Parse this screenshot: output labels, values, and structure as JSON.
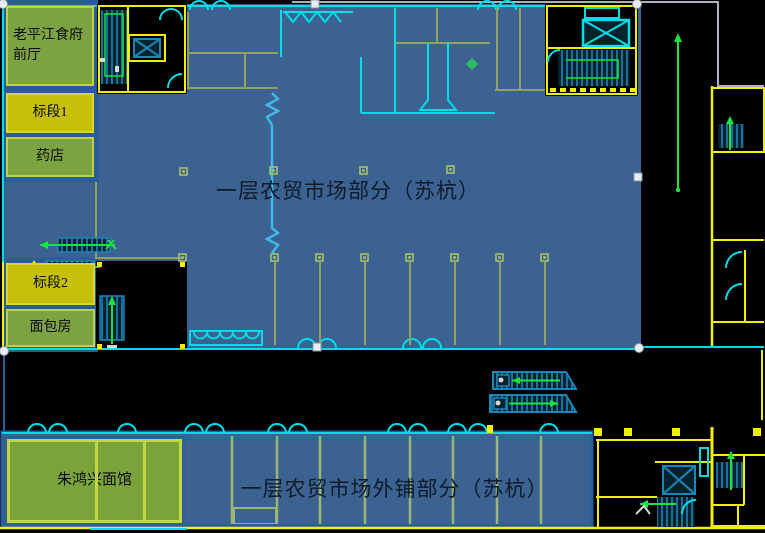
{
  "titles": {
    "main_hall": "一层农贸市场部分（苏杭）",
    "outer_shops": "一层农贸市场外铺部分（苏杭）"
  },
  "left_panel": {
    "boxes": [
      {
        "label": "老平江食府前厅",
        "type": "green"
      },
      {
        "label": "标段1",
        "type": "yellow"
      },
      {
        "label": "药店",
        "type": "green"
      },
      {
        "label": "标段2",
        "type": "yellow"
      },
      {
        "label": "面包房",
        "type": "green"
      }
    ]
  },
  "bottom_strip": {
    "shop_label": "朱鸿兴面馆"
  },
  "colors": {
    "hall_fill": "#3b6291",
    "panel_backing_blue": "#2a5d95",
    "zone_green": "#7ca341",
    "zone_green_border": "#bdd14c",
    "zone_yellow": "#c6c00a",
    "noodle_green": "#7aa339",
    "cad_yellow": "#f2ef00",
    "cad_cyan": "#00dcea",
    "cad_green": "#17e53c",
    "cad_teal": "#1b86b8",
    "partition_olive": "#93a25a",
    "partition_light_green": "#9cb577",
    "outline_gray": "#aab3bd",
    "title_text": "#0e1b2a",
    "background": "#000000"
  }
}
